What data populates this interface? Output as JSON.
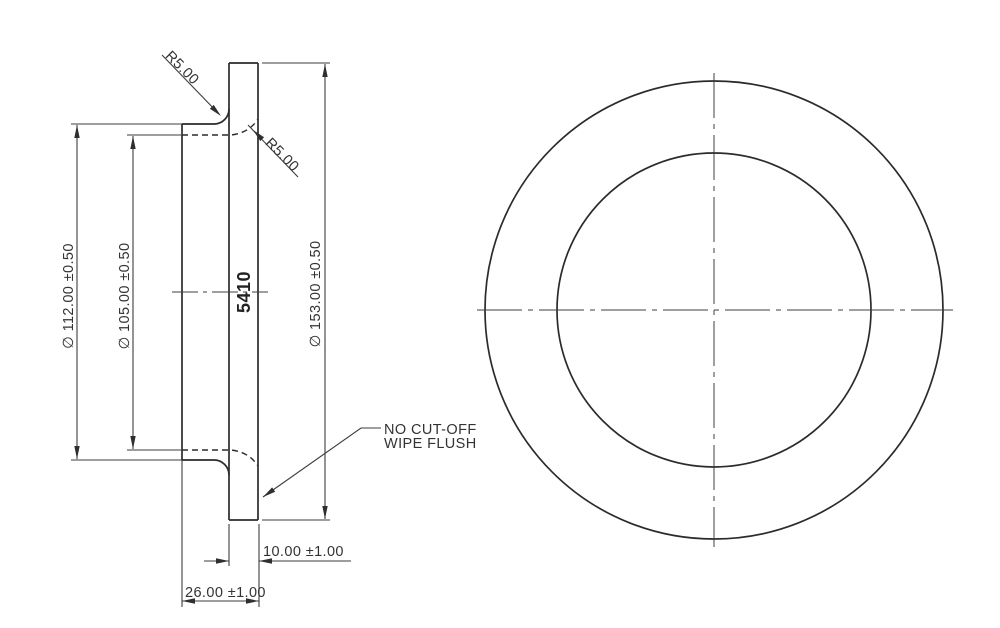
{
  "drawing_type": "engineering-drawing",
  "part": {
    "marking": "5410",
    "notes": [
      "NO CUT-OFF",
      "WIPE FLUSH"
    ],
    "dimensions_mm": {
      "flange_diameter": "153.00 ±0.50",
      "hub_diameter": "112.00 ±0.50",
      "bore_diameter": "105.00 ±0.50",
      "flange_thickness": "10.00 ±1.00",
      "overall_length": "26.00 ±1.00",
      "fillet_radius_outer": "5.00",
      "fillet_radius_inner": "5.00"
    }
  },
  "side_view": {
    "fillet_outer_label": "R5.00",
    "fillet_inner_label": "R5.00",
    "hub_diameter_label": "∅ 112.00 ±0.50",
    "bore_diameter_label": "∅ 105.00 ±0.50",
    "flange_diameter_label": "∅ 153.00 ±0.50",
    "part_marking": "5410",
    "thickness_label": "10.00 ±1.00",
    "length_label": "26.00 ±1.00",
    "note_line1": "NO CUT-OFF",
    "note_line2": "WIPE FLUSH"
  },
  "colors": {
    "background": "#ffffff",
    "outline": "#2b2b2b",
    "dimension": "#3c3c3c",
    "text": "#333333"
  }
}
